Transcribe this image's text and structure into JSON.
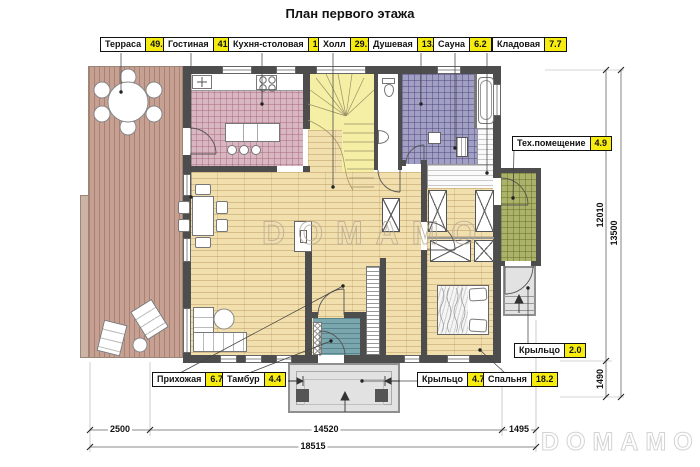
{
  "title": "План первого этажа",
  "watermarks": {
    "center": "DOMAMO",
    "corner": "DOMAMO"
  },
  "room_labels": [
    {
      "name": "Терраса",
      "area": "49.4"
    },
    {
      "name": "Гостиная",
      "area": "41.6"
    },
    {
      "name": "Кухня-столовая",
      "area": "19.0"
    },
    {
      "name": "Холл",
      "area": "29.7"
    },
    {
      "name": "Душевая",
      "area": "13.5"
    },
    {
      "name": "Сауна",
      "area": "6.2"
    },
    {
      "name": "Кладовая",
      "area": "7.7"
    },
    {
      "name": "Тех.помещение",
      "area": "4.9"
    },
    {
      "name": "Крыльцо",
      "area": "2.0"
    },
    {
      "name": "Прихожая",
      "area": "6.7"
    },
    {
      "name": "Тамбур",
      "area": "4.4"
    },
    {
      "name": "Крыльцо",
      "area": "4.7"
    },
    {
      "name": "Спальня",
      "area": "18.2"
    }
  ],
  "dimensions": {
    "bottom_left": "2500",
    "bottom_center": "14520",
    "bottom_right": "1495",
    "bottom_total": "18515",
    "right_main": "12010",
    "right_lower": "1490",
    "right_total": "13500"
  },
  "colors": {
    "area_badge": "#f7ec0f",
    "wall": "#4d4d4d",
    "deck": "#c5a093",
    "wood_floor": "#f2dfae",
    "kitchen_tile": "#d8b6c2",
    "shower_tile": "#a19fc4",
    "stair": "#f5efa6",
    "tech_tile": "#abb269",
    "tambur": "#7aa6ae",
    "porch": "#e2e2e2"
  }
}
